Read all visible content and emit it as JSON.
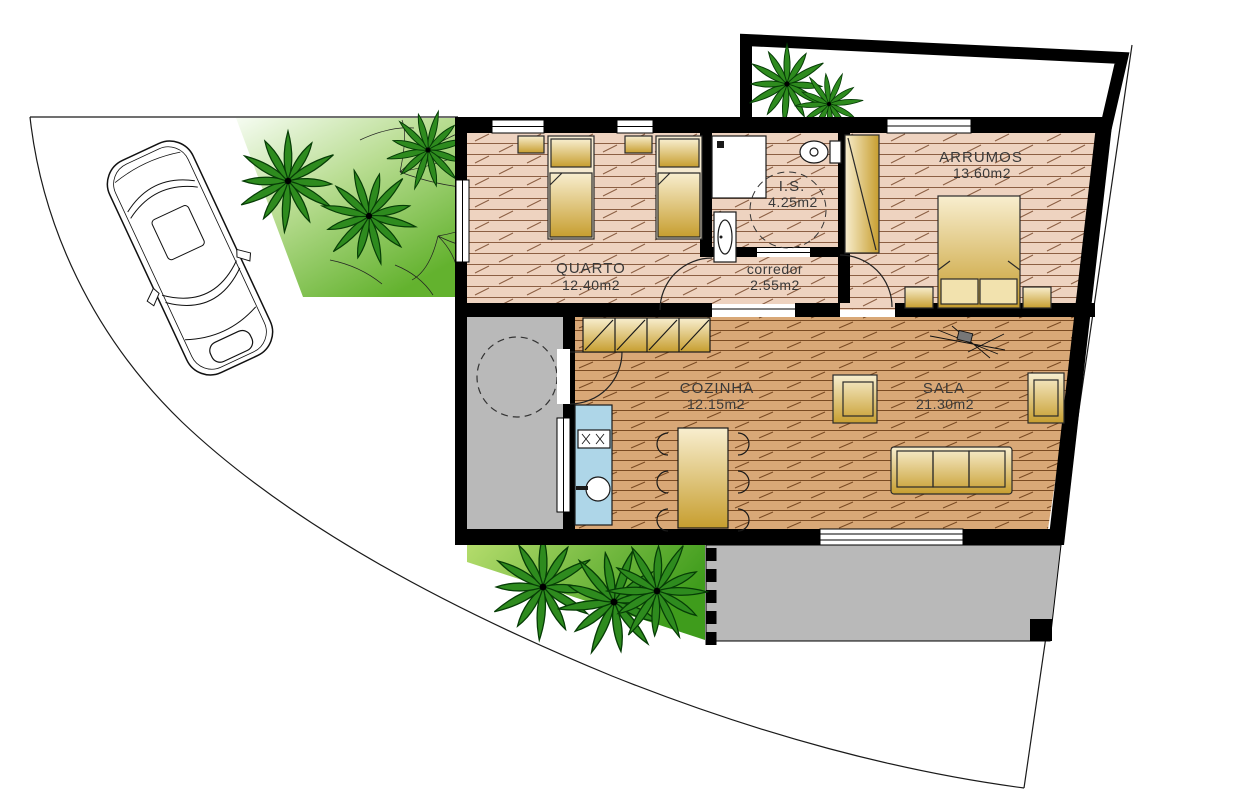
{
  "plan": {
    "type": "architectural-floor-plan",
    "rooms": [
      {
        "name": "QUARTO",
        "area": "12.40m2"
      },
      {
        "name": "I.S.",
        "area": "4.25m2"
      },
      {
        "name": "corredor",
        "area": "2.55m2"
      },
      {
        "name": "ARRUMOS",
        "area": "13.60m2"
      },
      {
        "name": "COZINHA",
        "area": "12.15m2"
      },
      {
        "name": "SALA",
        "area": "21.30m2"
      }
    ]
  },
  "palette": {
    "wall": "#000000",
    "floor_bedroom_zone": "#eed3c0",
    "floor_living_zone": "#d9a877",
    "plank_line_top": "#8c5f43",
    "plank_line_low": "#7a4a22",
    "patio_gray": "#b9b9b9",
    "kitchen_counter_blue": "#aed6e8",
    "furniture_light": "#f8eecf",
    "furniture_dark": "#c79e2f",
    "garden_light": "#f2faee",
    "garden_dark": "#4aa31d",
    "palm_green": "#2e8b1e"
  }
}
